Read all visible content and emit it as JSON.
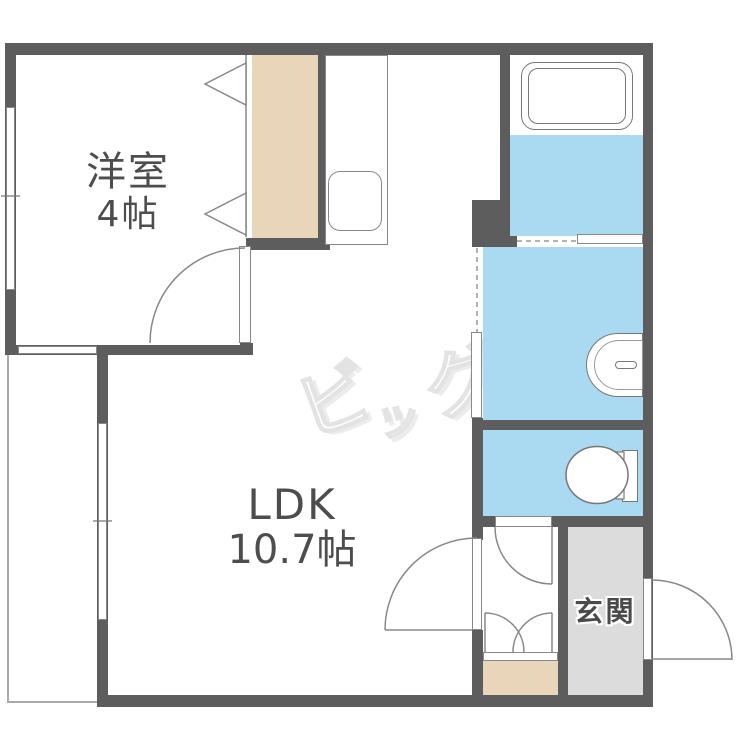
{
  "floorplan": {
    "rooms": {
      "western_room": {
        "name_line1": "洋室",
        "name_line2": "4帖"
      },
      "ldk": {
        "name_line1": "LDK",
        "name_line2": "10.7帖"
      },
      "entrance": {
        "name": "玄関"
      }
    },
    "watermark": {
      "text": "ビッグ",
      "chars": [
        "ビ",
        "ッ",
        "グ"
      ]
    },
    "fixtures": [
      "bathtub-icon",
      "kitchen-sink-icon",
      "washbasin-icon",
      "toilet-icon",
      "closet-bifold-door-icon"
    ],
    "colors": {
      "wall": "#5d5d5d",
      "wet_area_floor": "#aadaf2",
      "closet_floor": "#e8d5ba",
      "entry_dirt_floor": "#e8d5ba",
      "entrance_floor": "#dcdcdc",
      "room_label_text": "#4d4d4d",
      "fixture_outline": "#888888",
      "watermark_color": "#e3e3e3"
    }
  }
}
